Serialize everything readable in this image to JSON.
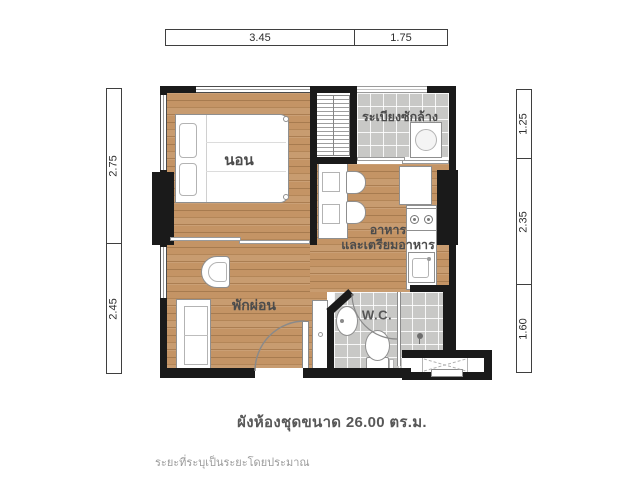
{
  "meta": {
    "caption": "ผังห้องชุดขนาด 26.00 ตร.ม.",
    "area_sqm": "26.00",
    "disclaimer": "ระยะที่ระบุเป็นระยะโดยประมาณ"
  },
  "dimensions": {
    "top": [
      "3.45",
      "1.75"
    ],
    "left": [
      "2.75",
      "2.45"
    ],
    "right": [
      "1.25",
      "2.35",
      "1.60"
    ]
  },
  "rooms": {
    "bedroom": "นอน",
    "balcony": "ระเบียงซักล้าง",
    "kitchen_line1": "อาหาร",
    "kitchen_line2": "และเตรียมอาหาร",
    "living": "พักผ่อน",
    "wc": "W.C."
  },
  "colors": {
    "wall": "#1a1a1a",
    "wood_floor": "#c49465",
    "tile_floor": "#c8c8c6",
    "label_text": "#4c4c4c",
    "caption_text": "#585858",
    "disclaimer_text": "#9b9b9b"
  }
}
